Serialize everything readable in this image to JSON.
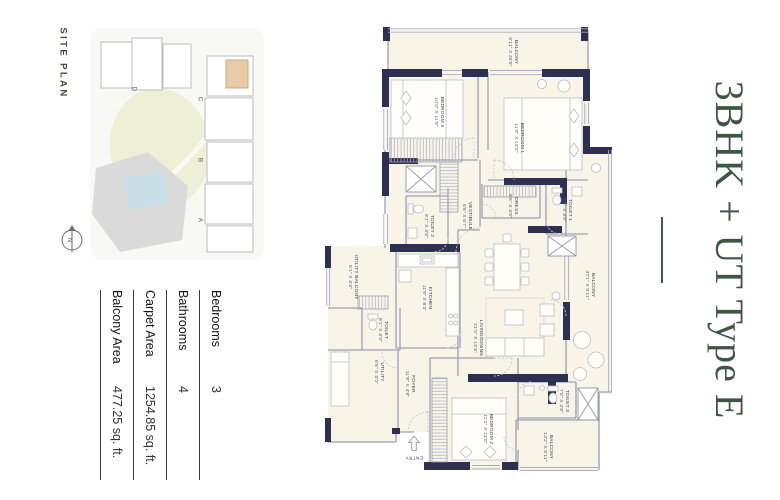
{
  "title": {
    "text": "3BHK + UT Type E",
    "color": "#3e5743"
  },
  "site_plan": {
    "heading": "SITE PLAN",
    "tower_labels": [
      "D",
      "C",
      "B",
      "A"
    ],
    "north_label": "N",
    "highlight_color": "#e8cba6",
    "lawn_color": "#edf0d6",
    "pool_color": "#c7e0e8",
    "building_color": "#dadada"
  },
  "specs": {
    "rows": [
      {
        "label": "Bedrooms",
        "value": "3"
      },
      {
        "label": "Bathrooms",
        "value": "4"
      },
      {
        "label": "Carpet Area",
        "value": "1254.85 sq. ft."
      },
      {
        "label": "Balcony Area",
        "value": "477.25 sq. ft."
      }
    ]
  },
  "floor_plan": {
    "wall_color": "#2e3052",
    "floor_color": "#f8f4e8",
    "entry_label": "ENTRY",
    "rooms": [
      {
        "name": "BALCONY",
        "dims": "5'11\" X 28'8\""
      },
      {
        "name": "BEDROOM 3",
        "dims": "10'0\" X 11'0\""
      },
      {
        "name": "BEDROOM 1",
        "dims": "11'0\" X 13'0\""
      },
      {
        "name": "TOILET 2",
        "dims": "8'1\" X 4'8\""
      },
      {
        "name": "VESTIBULE",
        "dims": "6'6\" X 6'7\""
      },
      {
        "name": "DRESS",
        "dims": "9'6\" X 4'8\""
      },
      {
        "name": "TOILET 1",
        "dims": "9'4\" X 4'8\""
      },
      {
        "name": "KITCHEN",
        "dims": "11'8\" X 8'0\""
      },
      {
        "name": "UTILITY BALCONY",
        "dims": "5'1\" X 4'4\""
      },
      {
        "name": "TOILET",
        "dims": "6'1\" X 4'0\""
      },
      {
        "name": "UTILITY",
        "dims": "6'6\" X 4'0\""
      },
      {
        "name": "FOYER",
        "dims": "11'8\" X 4'8\""
      },
      {
        "name": "LIVING/DINING",
        "dims": "21'0\" X 14'4\""
      },
      {
        "name": "BALCONY",
        "dims": "47'1\" X 5'11\""
      },
      {
        "name": "BEDROOM 2",
        "dims": "11'2\" X 13'0\""
      },
      {
        "name": "TOILET 3",
        "dims": "7'8\" X 4'8\""
      },
      {
        "name": "BALCONY",
        "dims": "13'2\" X 5'11\""
      }
    ]
  }
}
